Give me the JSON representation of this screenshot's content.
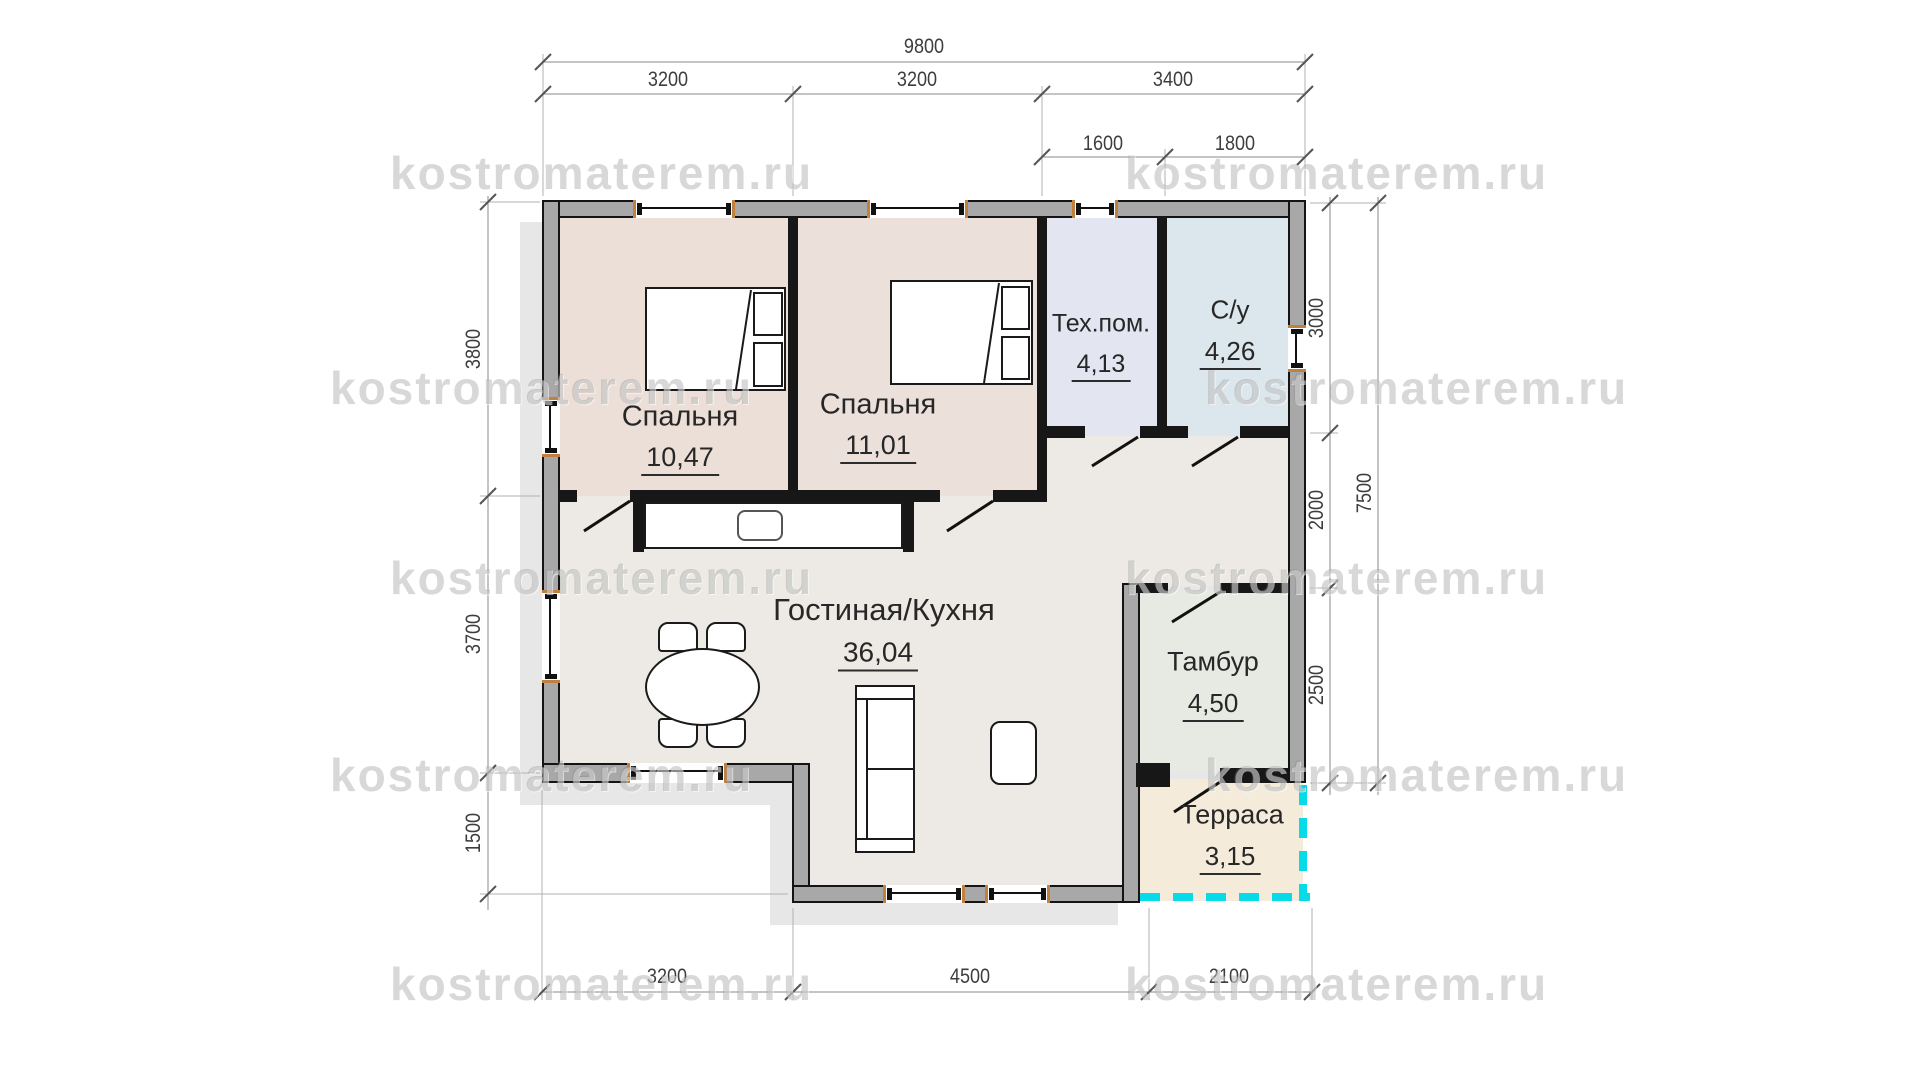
{
  "watermark": {
    "text": "kostromaterem.ru"
  },
  "rooms": [
    {
      "id": "bedroom-1",
      "name": "Спальня",
      "area": "10,47"
    },
    {
      "id": "bedroom-2",
      "name": "Спальня",
      "area": "11,01"
    },
    {
      "id": "tech-room",
      "name": "Тех.пом.",
      "area": "4,13"
    },
    {
      "id": "bathroom",
      "name": "С/у",
      "area": "4,26"
    },
    {
      "id": "living-kitchen",
      "name": "Гостиная/Кухня",
      "area": "36,04"
    },
    {
      "id": "vestibule",
      "name": "Тамбур",
      "area": "4,50"
    },
    {
      "id": "terrace",
      "name": "Терраса",
      "area": "3,15"
    }
  ],
  "dimensions": {
    "top_total": "9800",
    "top_segments": [
      "3200",
      "3200",
      "3400"
    ],
    "top_sub": [
      "1600",
      "1800"
    ],
    "left": [
      "3800",
      "3700",
      "1500"
    ],
    "right": [
      "3000",
      "2000",
      "2500"
    ],
    "right_total": "7500",
    "bottom": [
      "3200",
      "4500",
      "2100"
    ]
  },
  "colors": {
    "floor_bedroom": "#ecdfd8",
    "floor_tech": "#e3e6f1",
    "floor_bath": "#dbe6ed",
    "floor_living": "#edeae5",
    "floor_vestibule": "#e7eae3",
    "floor_terrace": "#f4ebda",
    "wall_fill": "#a8a8a8",
    "wall_line": "#141414",
    "window_jamb": "#c08040",
    "terrace_dash": "#07dbe8",
    "watermark_gray": "#bdbdbd"
  }
}
